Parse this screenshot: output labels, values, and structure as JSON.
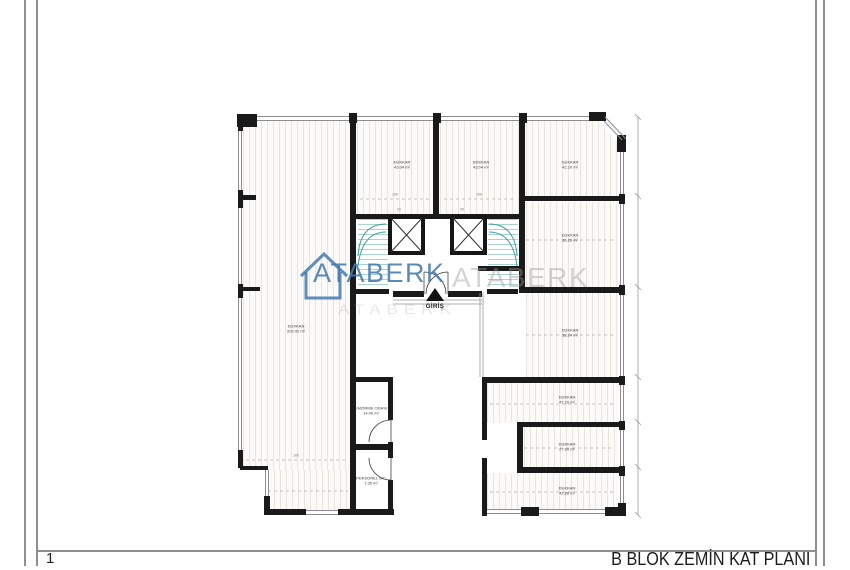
{
  "page": {
    "sheet_number": "1",
    "title": "B BLOK ZEMİN KAT PLANI"
  },
  "watermark": {
    "brand": "ATABERK",
    "echo": "ATABERK",
    "echo2": "ATABERK",
    "color": "#4a7ab1"
  },
  "entrance": {
    "label": "GİRİŞ"
  },
  "rooms": {
    "shop_main": {
      "name": "DÜKKAN",
      "area": "202.42 m²"
    },
    "shop_1": {
      "name": "DÜKKAN",
      "area": "43.04 m²"
    },
    "shop_2": {
      "name": "DÜKKAN",
      "area": "43.04 m²"
    },
    "shop_3": {
      "name": "DÜKKAN",
      "area": "42.20 m²"
    },
    "shop_4": {
      "name": "DÜKKAN",
      "area": "36.20 m²"
    },
    "shop_5": {
      "name": "DÜKKAN",
      "area": "38.24 m²"
    },
    "shop_6": {
      "name": "DÜKKAN",
      "area": "47.20 m²"
    },
    "shop_7": {
      "name": "DÜKKAN",
      "area": "27.90 m²"
    },
    "shop_8": {
      "name": "DÜKKAN",
      "area": "42.86 m²"
    },
    "service_1": {
      "name": "EMZİRME ODASI",
      "area": "14.00 m²"
    },
    "service_2": {
      "name": "PERSONEL WC",
      "area": "7.35 m²"
    }
  },
  "dims": {
    "elev_left": "20",
    "elev_right": "20",
    "top_1": "100",
    "top_2": "100",
    "left_1": "100"
  }
}
